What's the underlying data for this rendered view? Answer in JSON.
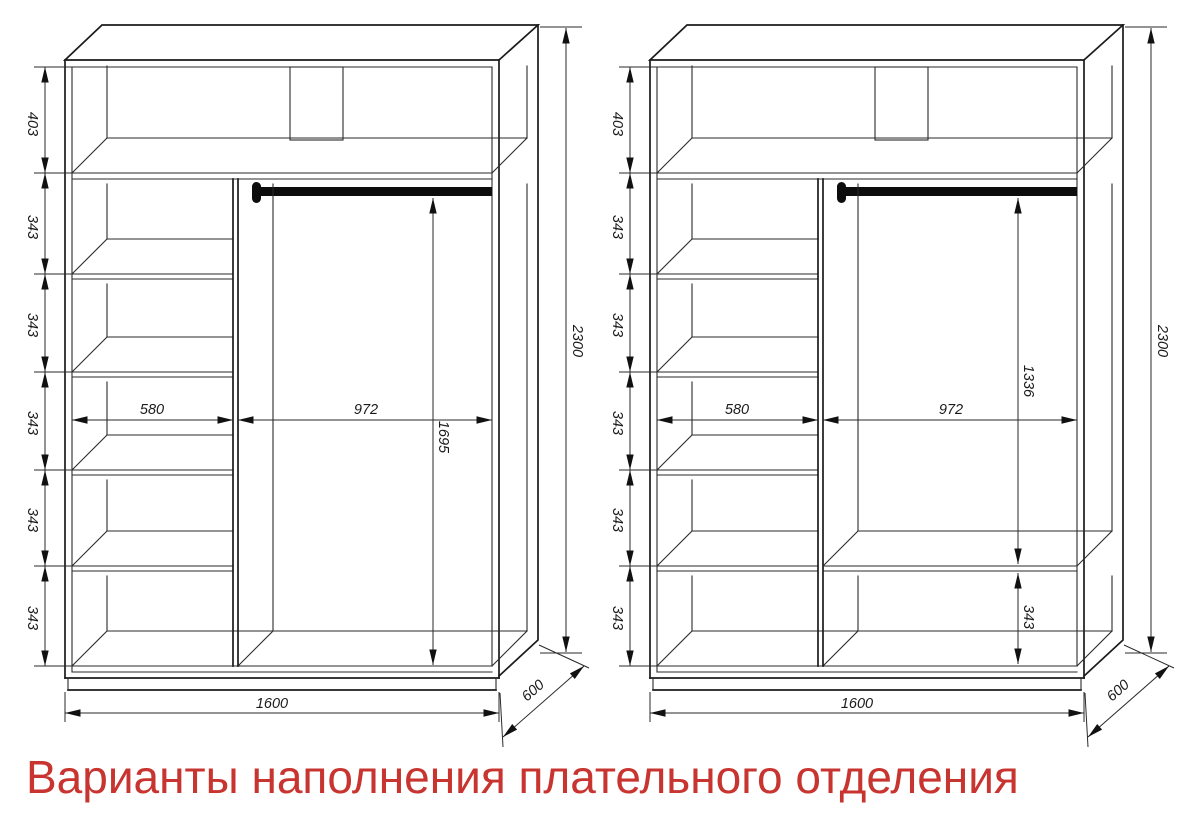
{
  "title": {
    "text": "Варианты наполнения плательного отделения",
    "color": "#c8342f"
  },
  "drawing": {
    "line_color": "#1b1b1b",
    "units": "mm"
  },
  "wardrobes": [
    {
      "id": "variant-1",
      "dims": {
        "top_section": "403",
        "shelf_gap": "343",
        "shelf_width": "580",
        "hanging_width": "972",
        "hanging_height": "1695",
        "total_height": "2300",
        "total_width": "1600",
        "depth": "600"
      }
    },
    {
      "id": "variant-2",
      "dims": {
        "top_section": "403",
        "shelf_gap": "343",
        "shelf_width": "580",
        "hanging_width": "972",
        "hanging_height": "1336",
        "below_shelf_gap": "343",
        "total_height": "2300",
        "total_width": "1600",
        "depth": "600"
      }
    }
  ]
}
